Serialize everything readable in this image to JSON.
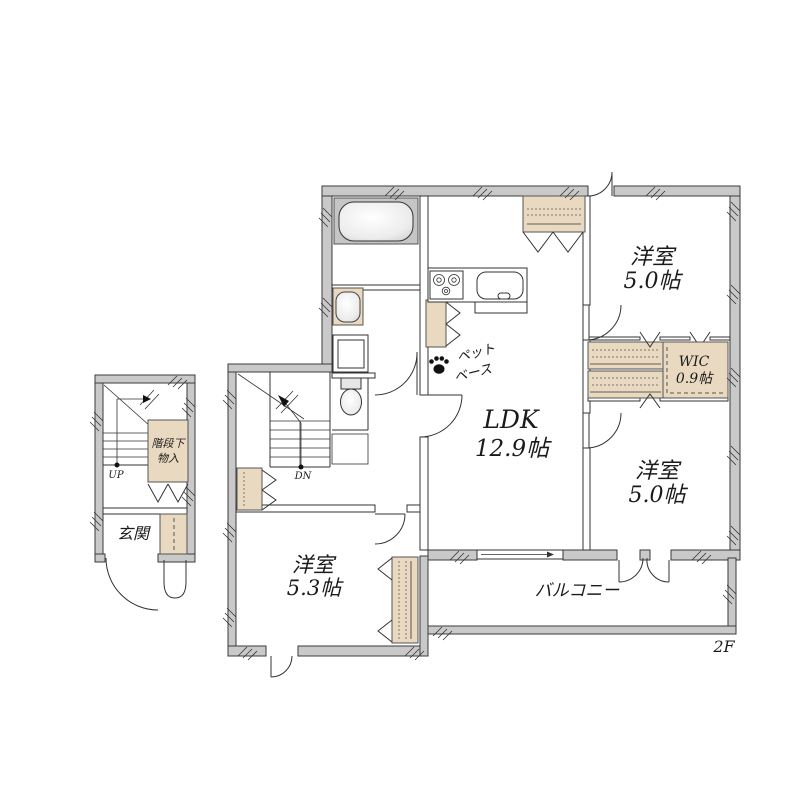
{
  "floor_label": "2F",
  "rooms": {
    "bedroom_ne": {
      "name": "洋室",
      "size": "5.0帖"
    },
    "bedroom_se": {
      "name": "洋室",
      "size": "5.0帖"
    },
    "bedroom_sw": {
      "name": "洋室",
      "size": "5.3帖"
    },
    "ldk": {
      "name": "LDK",
      "size": "12.9帖"
    },
    "wic": {
      "name": "WIC",
      "size": "0.9帖"
    },
    "balcony": {
      "name": "バルコニー"
    },
    "entrance": {
      "name": "玄関"
    },
    "under_stairs_storage": {
      "line1": "階段下",
      "line2": "物入"
    },
    "pet_base": {
      "line1": "ペット",
      "line2": "ベース"
    }
  },
  "stairs": {
    "up": "UP",
    "down": "DN"
  },
  "colors": {
    "exterior_wall": "#c9c9c9",
    "closet_fill": "#ead9c1",
    "outline": "#3a3a3a",
    "text": "#1a1a1a"
  }
}
